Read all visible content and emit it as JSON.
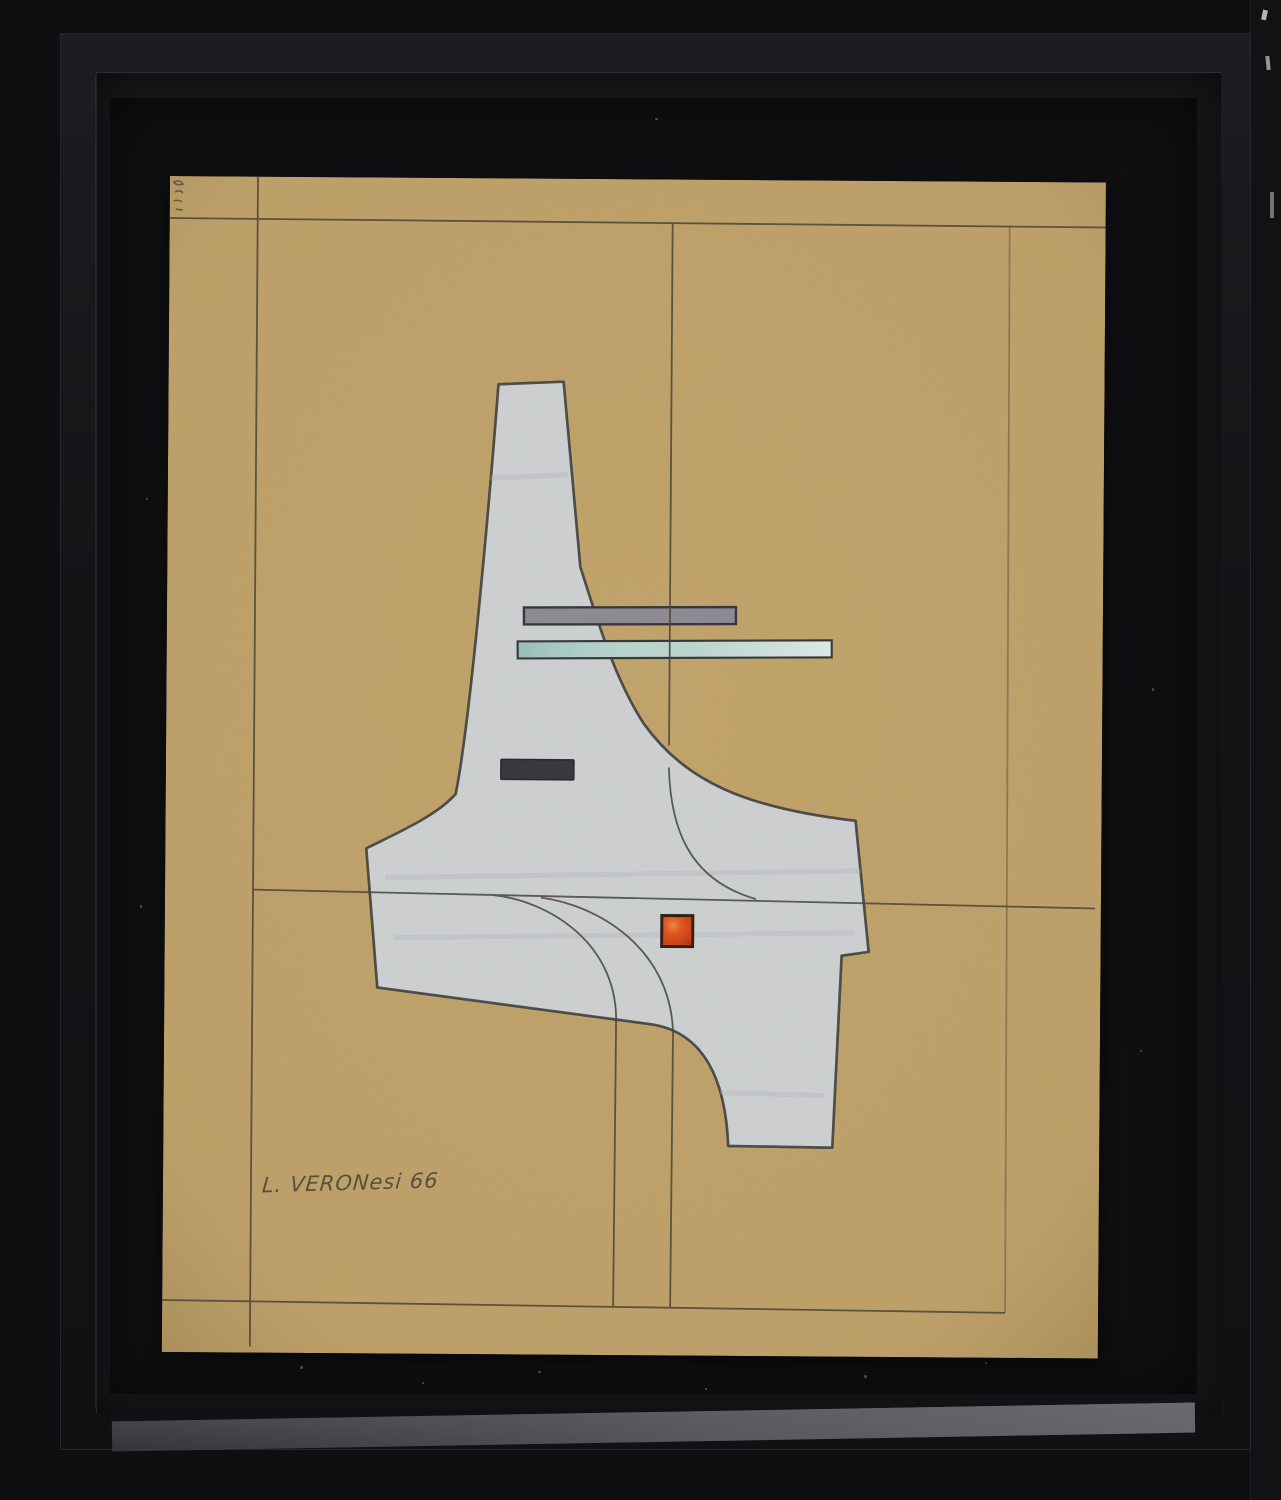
{
  "artwork": {
    "signature": "L. VERONesi 66"
  },
  "colors": {
    "frame_outer": "#0f0f12",
    "frame_bevel": "#17171a",
    "frame_inner": "#17171a",
    "mat_black": "#101013",
    "reflection_gray": "#6d6d72",
    "paper_ochre": "#c2a46c",
    "shape_gray_white": "#cdd0d1",
    "shape_outline": "#4b4a46",
    "bar_gray": "#8e8a94",
    "bar_teal": "#aeccc5",
    "bar_outline": "#3a373b",
    "rect_dark": "#39383c",
    "square_orange": "#d8491d",
    "square_border": "#332112",
    "pencil": "#4a443a",
    "signature_ink": "#56503f"
  }
}
